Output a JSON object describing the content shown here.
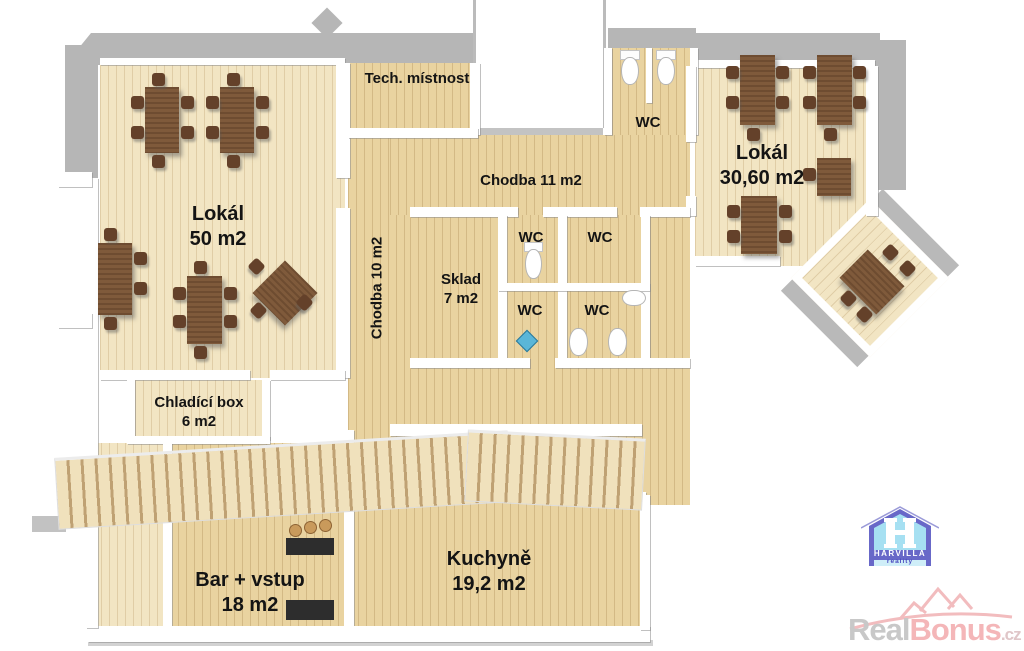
{
  "plan_title": "Restaurant floor plan",
  "rooms": {
    "lokal50": {
      "name": "Lokál",
      "area": "50 m2"
    },
    "tech": {
      "name": "Tech. místnost"
    },
    "chodba11": {
      "name": "Chodba 11 m2"
    },
    "chodba10": {
      "name": "Chodba 10 m2"
    },
    "wc_top": {
      "name": "WC"
    },
    "lokal3060": {
      "name": "Lokál",
      "area": "30,60 m2"
    },
    "sklad": {
      "name": "Sklad",
      "area": "7 m2"
    },
    "wc_a": {
      "name": "WC"
    },
    "wc_b": {
      "name": "WC"
    },
    "wc_c": {
      "name": "WC"
    },
    "wc_d": {
      "name": "WC"
    },
    "chladici": {
      "name": "Chladící box",
      "area": "6 m2"
    },
    "bar": {
      "name": "Bar + vstup",
      "area": "18 m2"
    },
    "kuchyne": {
      "name": "Kuchyně",
      "area": "19,2 m2"
    }
  },
  "branding": {
    "harvilla": {
      "title": "HARVILLA",
      "subtitle": "reality"
    },
    "realbonus": {
      "word1": "Real",
      "word2": "Bonus",
      "suffix": ".cz"
    }
  },
  "colors": {
    "floor_pale": "#f2e5c3",
    "floor_gold": "#e9d3a0",
    "wall_white": "#ffffff",
    "wall_gray": "#b6b6b6",
    "table_brown": "#7f5a3b",
    "chair_brown": "#64412a",
    "label_text": "#141414",
    "logo_blue": "#6868c8",
    "logo_cyan": "#a6e0f2",
    "watermark_gray": "#c8c8c8",
    "watermark_pink": "#f4b6b8"
  }
}
